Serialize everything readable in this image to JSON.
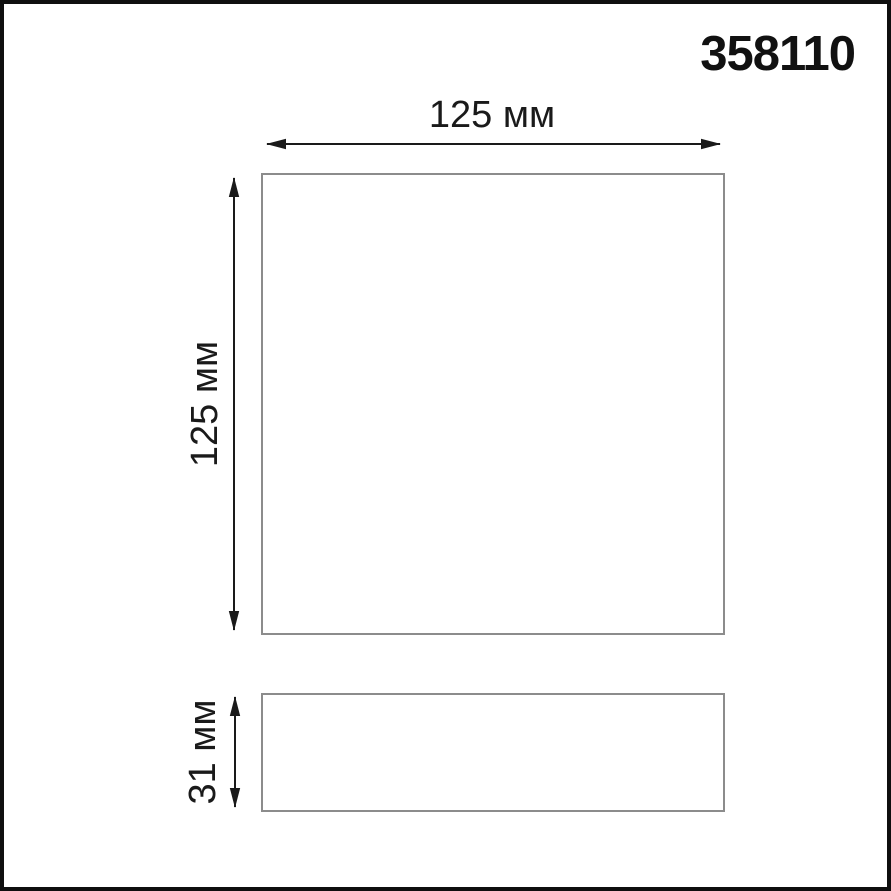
{
  "article_number": "358110",
  "dimensions": {
    "width_label": "125 мм",
    "height_label": "125 мм",
    "depth_label": "31 мм"
  },
  "colors": {
    "background": "#ffffff",
    "frame_border": "#0f0f0f",
    "shape_outline": "#8c8c8c",
    "ink": "#1a1a1a"
  }
}
